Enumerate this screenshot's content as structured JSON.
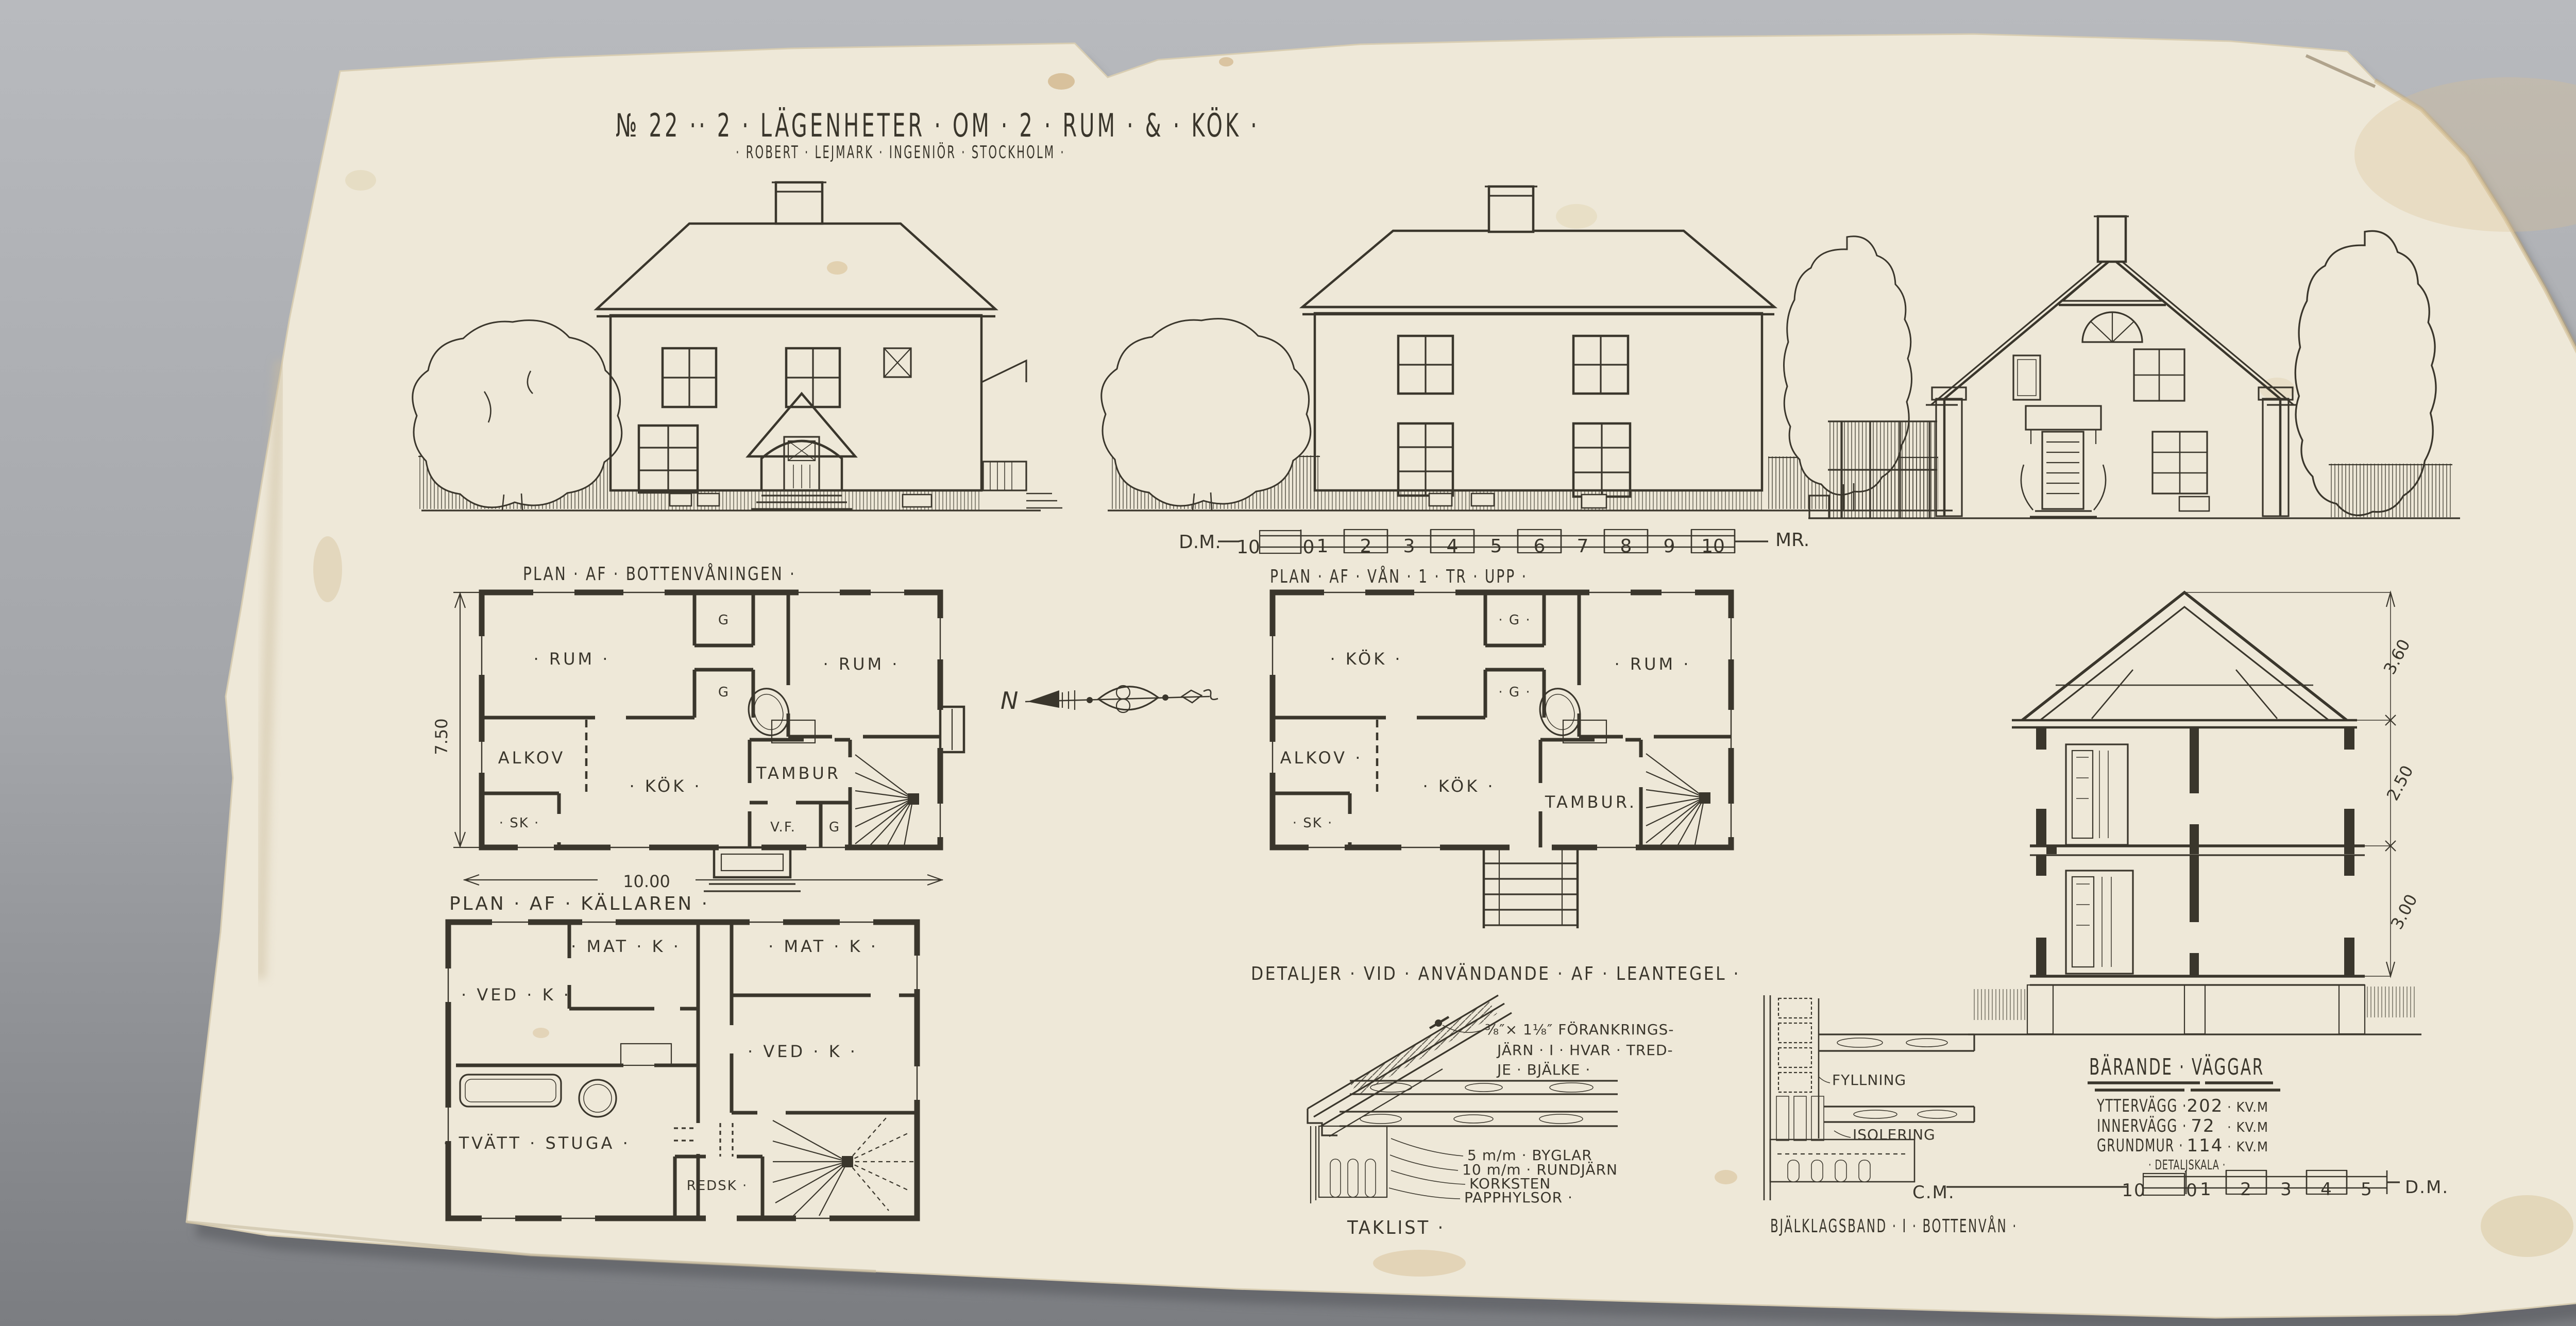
{
  "scene": {
    "background_top": "#b8babe",
    "background_bottom": "#7b7d81",
    "paper": "#eee8d8",
    "ink": "#3a362c"
  },
  "title": {
    "main": "№ 22 ·· 2 · LÄGENHETER · OM · 2 · RUM · & · KÖK ·",
    "sub": "· ROBERT · LEJMARK · INGENIÖR · STOCKHOLM ·"
  },
  "compass": {
    "letter": "N"
  },
  "scale_main": {
    "left_label": "D.M.",
    "ticks": [
      "10",
      "0",
      "1",
      "2",
      "3",
      "4",
      "5",
      "6",
      "7",
      "8",
      "9",
      "10"
    ],
    "right_label": "MR."
  },
  "plans": {
    "ground": {
      "title": "PLAN · AF · BOTTENVÅNINGEN ·",
      "dim_h": "7.50",
      "dim_w": "10.00",
      "rooms": {
        "rum1": "· RUM ·",
        "rum2": "· RUM ·",
        "alkov": "ALKOV",
        "kok": "· KÖK ·",
        "tambur": "TAMBUR",
        "sk": "· SK ·",
        "vf": "V.F.",
        "g1": "G",
        "g2": "G",
        "g3": "G"
      }
    },
    "upper": {
      "title": "PLAN · AF · VÅN · 1 · TR · UPP ·",
      "rooms": {
        "kok1": "· KÖK ·",
        "rum": "· RUM ·",
        "alkov": "ALKOV ·",
        "kok2": "· KÖK ·",
        "tambur": "TAMBUR.",
        "sk": "· SK ·",
        "g1": "· G ·",
        "g2": "· G ·"
      }
    },
    "cellar": {
      "title": "PLAN · AF · KÄLLAREN ·",
      "rooms": {
        "matk1": "· MAT · K ·",
        "matk2": "· MAT · K ·",
        "vedk1": "· VED · K ·",
        "vedk2": "· VED · K ·",
        "tvatt": "· TVÄTT · STUGA ·",
        "redsk": "REDSK ·"
      }
    }
  },
  "section": {
    "dims": [
      "3.60",
      "2.50",
      "3.00"
    ]
  },
  "details": {
    "heading": "DETALJER · VID · ANVÄNDANDE · AF · LEANTEGEL ·",
    "anchor": [
      "⅜″× 1⅛″ FÖRANKRINGS-",
      "JÄRN · I · HVAR · TRED-",
      "JE · BJÄLKE ·"
    ],
    "byglar": "5 m/m · BYGLAR",
    "rundjarn": "10 m/m · RUNDJÄRN",
    "korksten": "KORKSTEN",
    "papphylsor": "PAPPHYLSOR ·",
    "caption_left": "TAKLIST ·",
    "fyllning": "FYLLNING",
    "isolering": "ISOLERING",
    "caption_right": "BJÄLKLAGSBAND · I · BOTTENVÅN ·"
  },
  "walls_block": {
    "heading": "BÄRANDE · VÄGGAR",
    "rows": [
      {
        "label": "YTTERVÄGG ·",
        "value": "202",
        "unit": "· KV.M"
      },
      {
        "label": "INNERVÄGG ·",
        "value": "72",
        "unit": "· KV.M"
      },
      {
        "label": "GRUNDMUR ·",
        "value": "114",
        "unit": "· KV.M"
      }
    ],
    "subheading": "· DETALJSKALA ·"
  },
  "scale_detail": {
    "left_label": "C.M.",
    "ticks": [
      "10",
      "0",
      "1",
      "2",
      "3",
      "4",
      "5"
    ],
    "right_label": "D.M."
  },
  "monogram": {
    "initials": "AS",
    "year": "1915"
  }
}
